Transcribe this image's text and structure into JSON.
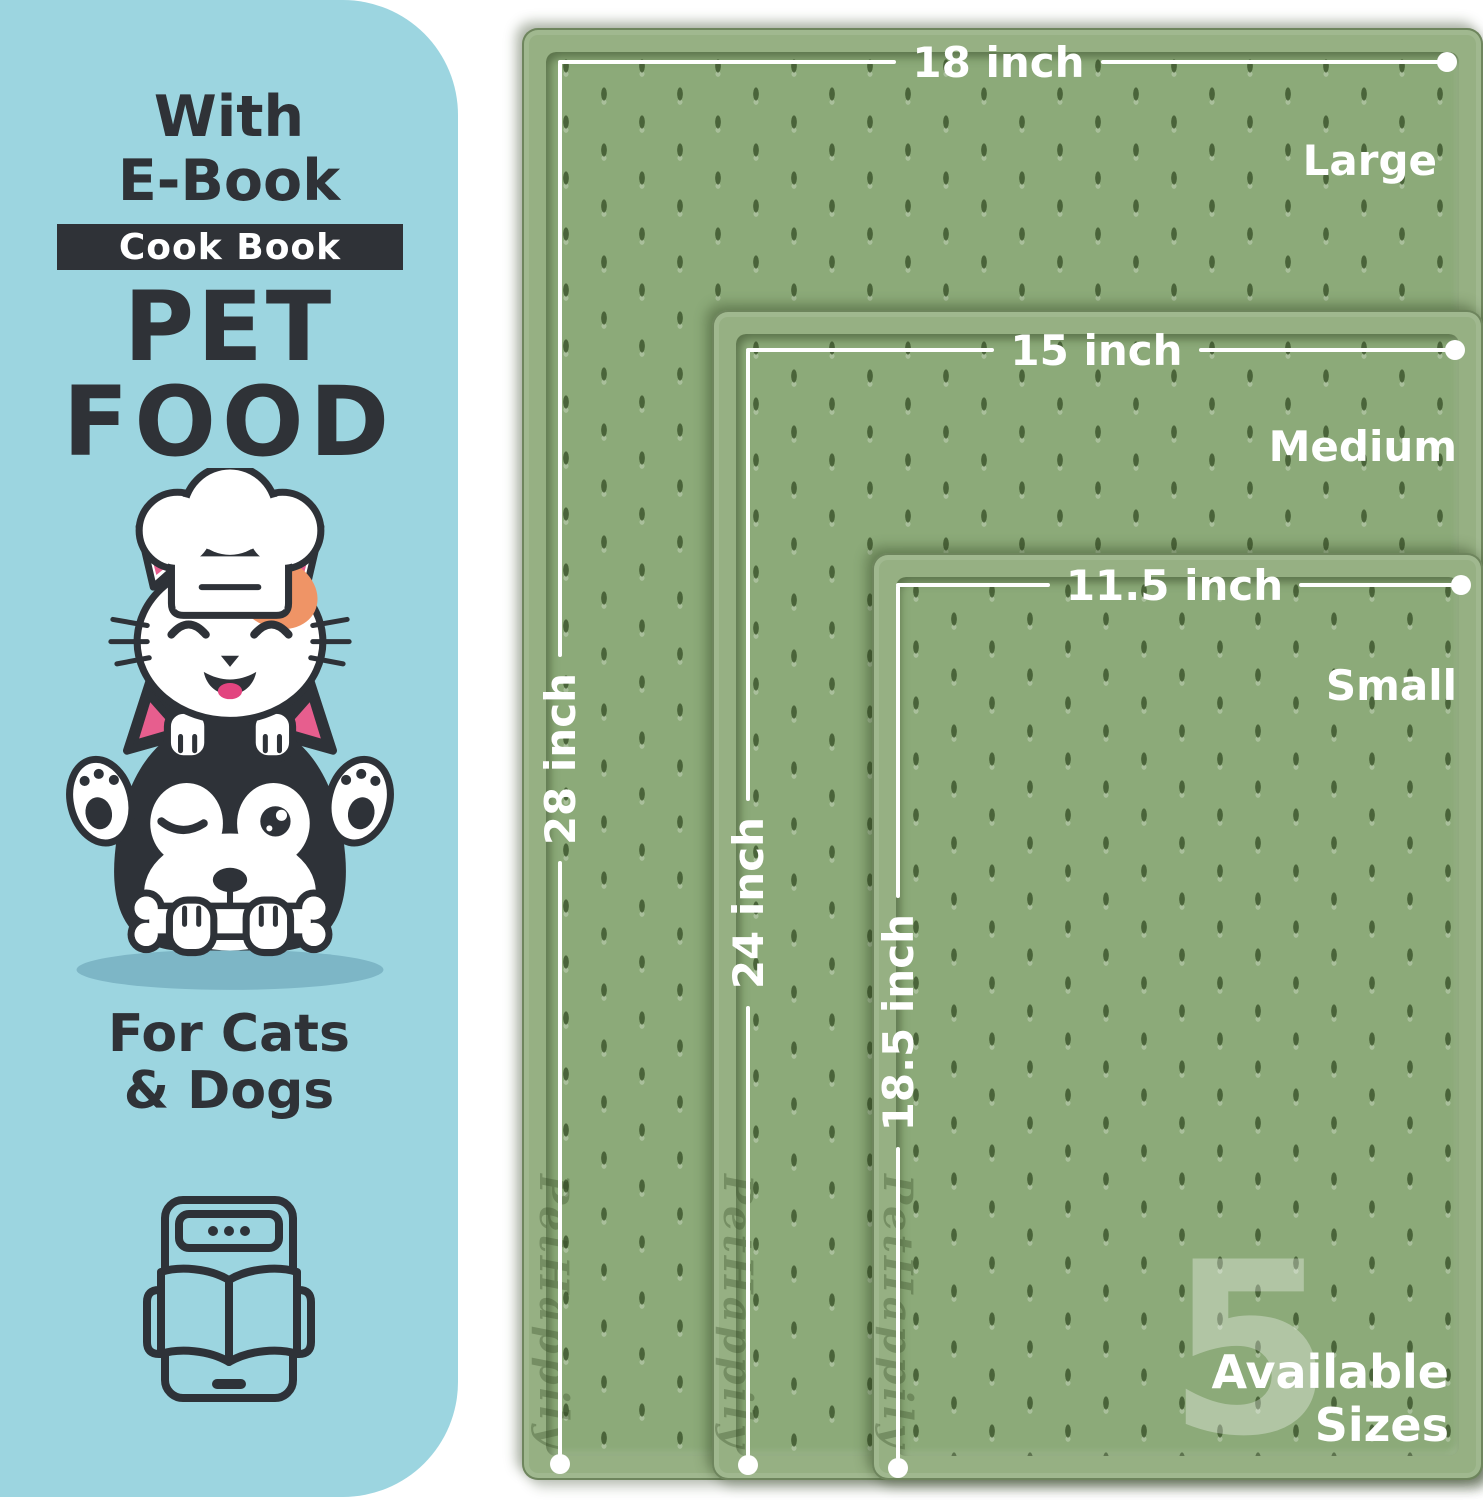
{
  "panel": {
    "heading": {
      "line1": "With",
      "line2": "E-Book"
    },
    "badge_label": "Cook Book",
    "title": {
      "line1": "PET",
      "line2": "FOOD"
    },
    "audience": {
      "line1": "For Cats",
      "line2": "& Dogs"
    },
    "illustration": "cat-chef-on-husky-with-bone",
    "ebook_icon": "tablet-with-open-book"
  },
  "mats": {
    "brand_embossed": "PetHappily",
    "items": [
      {
        "size_label": "Large",
        "width": "18 inch",
        "length": "28 inch"
      },
      {
        "size_label": "Medium",
        "width": "15 inch",
        "length": "24 inch"
      },
      {
        "size_label": "Small",
        "width": "11.5 inch",
        "length": "18.5 inch"
      }
    ],
    "available_sizes": {
      "number": "5",
      "line1": "Available",
      "line2": "Sizes"
    }
  },
  "colors": {
    "panel_blue": "#9cd5e0",
    "ink": "#2f3237",
    "mat_green": "#8caa79",
    "mat_rim": "#96b083",
    "measure_white": "#ffffff",
    "orange_patch": "#ef9466",
    "pink": "#e75e8e",
    "tongue_pink": "#e2447f",
    "shadow_blue": "#7db6c6"
  }
}
